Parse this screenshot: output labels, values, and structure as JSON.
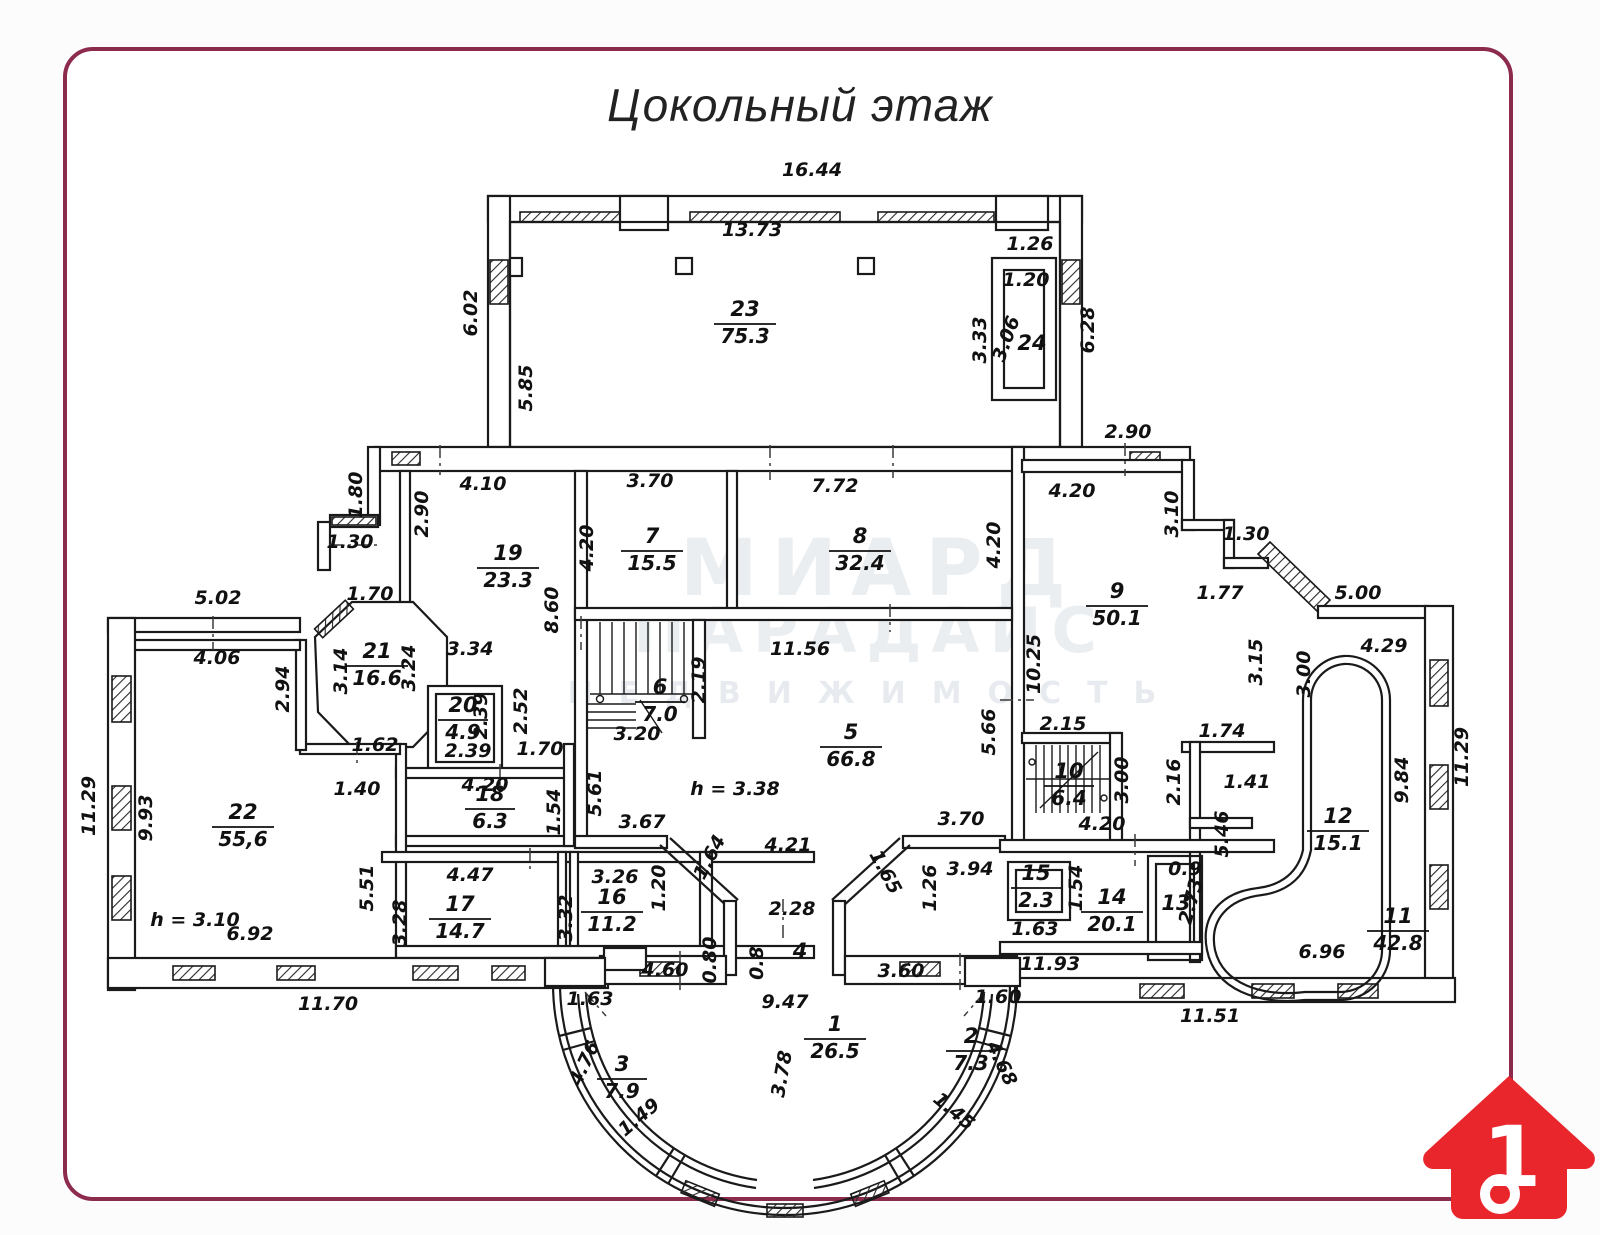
{
  "title": "Цокольный этаж",
  "watermark": {
    "line1": "МИАРД",
    "line2": "ПАРАДАИС",
    "line3": "НЕДВИЖИМОСТЬ"
  },
  "logo": {
    "number": "1",
    "house_color": "#e8262c"
  },
  "colors": {
    "border": "#8d2b4f",
    "lines": "#1a1a1a",
    "paper": "#ffffff"
  },
  "plan": {
    "rooms": [
      {
        "n": "23",
        "a": "75.3",
        "x": 745,
        "y": 316
      },
      {
        "n": "24",
        "a": null,
        "x": 1032,
        "y": 350
      },
      {
        "n": "19",
        "a": "23.3",
        "x": 508,
        "y": 560
      },
      {
        "n": "7",
        "a": "15.5",
        "x": 652,
        "y": 543
      },
      {
        "n": "8",
        "a": "32.4",
        "x": 860,
        "y": 543
      },
      {
        "n": "9",
        "a": "50.1",
        "x": 1117,
        "y": 598
      },
      {
        "n": "21",
        "a": "16.6",
        "x": 377,
        "y": 658
      },
      {
        "n": "20",
        "a": "4.9",
        "x": 463,
        "y": 712
      },
      {
        "n": "6",
        "a": "7.0",
        "x": 660,
        "y": 694
      },
      {
        "n": "5",
        "a": "66.8",
        "x": 851,
        "y": 739
      },
      {
        "n": "18",
        "a": "6.3",
        "x": 490,
        "y": 801
      },
      {
        "n": "22",
        "a": "55,6",
        "x": 243,
        "y": 819
      },
      {
        "n": "17",
        "a": "14.7",
        "x": 460,
        "y": 911
      },
      {
        "n": "16",
        "a": "11.2",
        "x": 612,
        "y": 904
      },
      {
        "n": "10",
        "a": "6.4",
        "x": 1069,
        "y": 778
      },
      {
        "n": "15",
        "a": "2.3",
        "x": 1036,
        "y": 880
      },
      {
        "n": "14",
        "a": "20.1",
        "x": 1112,
        "y": 904
      },
      {
        "n": "13",
        "a": null,
        "x": 1176,
        "y": 910
      },
      {
        "n": "12",
        "a": "15.1",
        "x": 1338,
        "y": 823
      },
      {
        "n": "11",
        "a": "42.8",
        "x": 1398,
        "y": 923
      },
      {
        "n": "4",
        "a": null,
        "x": 800,
        "y": 958
      },
      {
        "n": "1",
        "a": "26.5",
        "x": 835,
        "y": 1031
      },
      {
        "n": "2",
        "a": "7.3",
        "x": 971,
        "y": 1043
      },
      {
        "n": "3",
        "a": "7.9",
        "x": 622,
        "y": 1071
      }
    ],
    "dims": [
      {
        "t": "16.44",
        "x": 812,
        "y": 176
      },
      {
        "t": "13.73",
        "x": 752,
        "y": 236
      },
      {
        "t": "6.02",
        "x": 477,
        "y": 313,
        "r": -90
      },
      {
        "t": "5.85",
        "x": 532,
        "y": 388,
        "r": -90
      },
      {
        "t": "1.26",
        "x": 1030,
        "y": 250
      },
      {
        "t": "1.20",
        "x": 1026,
        "y": 286
      },
      {
        "t": "3.33",
        "x": 986,
        "y": 340,
        "r": -90
      },
      {
        "t": "3.06",
        "x": 1012,
        "y": 341,
        "r": -70
      },
      {
        "t": "6.28",
        "x": 1094,
        "y": 330,
        "r": -90
      },
      {
        "t": "2.90",
        "x": 1128,
        "y": 438
      },
      {
        "t": "1.80",
        "x": 362,
        "y": 495,
        "r": -90
      },
      {
        "t": "2.90",
        "x": 428,
        "y": 514,
        "r": -90
      },
      {
        "t": "4.10",
        "x": 483,
        "y": 490
      },
      {
        "t": "1.30",
        "x": 350,
        "y": 548
      },
      {
        "t": "5.02",
        "x": 218,
        "y": 604
      },
      {
        "t": "1.70",
        "x": 370,
        "y": 600
      },
      {
        "t": "4.06",
        "x": 217,
        "y": 664
      },
      {
        "t": "2.94",
        "x": 289,
        "y": 689,
        "r": -90
      },
      {
        "t": "3.14",
        "x": 347,
        "y": 671,
        "r": -90
      },
      {
        "t": "3.24",
        "x": 415,
        "y": 668,
        "r": -90
      },
      {
        "t": "1.62",
        "x": 375,
        "y": 751
      },
      {
        "t": "3.34",
        "x": 470,
        "y": 655
      },
      {
        "t": "8.60",
        "x": 558,
        "y": 610,
        "r": -90
      },
      {
        "t": "4.20",
        "x": 593,
        "y": 548,
        "r": -90
      },
      {
        "t": "3.70",
        "x": 650,
        "y": 487
      },
      {
        "t": "7.72",
        "x": 835,
        "y": 492
      },
      {
        "t": "4.20",
        "x": 1000,
        "y": 545,
        "r": -90
      },
      {
        "t": "2.39",
        "x": 487,
        "y": 716,
        "r": -90
      },
      {
        "t": "2.52",
        "x": 527,
        "y": 711,
        "r": -90
      },
      {
        "t": "2.39",
        "x": 468,
        "y": 757
      },
      {
        "t": "1.70",
        "x": 540,
        "y": 755
      },
      {
        "t": "1.40",
        "x": 357,
        "y": 795
      },
      {
        "t": "4.20",
        "x": 485,
        "y": 791
      },
      {
        "t": "1.54",
        "x": 560,
        "y": 812,
        "r": -90
      },
      {
        "t": "5.61",
        "x": 601,
        "y": 793,
        "r": -90
      },
      {
        "t": "3.67",
        "x": 642,
        "y": 828
      },
      {
        "t": "11.56",
        "x": 800,
        "y": 655
      },
      {
        "t": "2.19",
        "x": 705,
        "y": 680,
        "r": -90
      },
      {
        "t": "3.20",
        "x": 637,
        "y": 740
      },
      {
        "t": "h = 3.38",
        "x": 735,
        "y": 795
      },
      {
        "t": "5.66",
        "x": 995,
        "y": 732,
        "r": -90
      },
      {
        "t": "4.21",
        "x": 788,
        "y": 851
      },
      {
        "t": "1.64",
        "x": 715,
        "y": 860,
        "r": -62
      },
      {
        "t": "1.65",
        "x": 880,
        "y": 875,
        "r": 62
      },
      {
        "t": "3.70",
        "x": 961,
        "y": 825
      },
      {
        "t": "4.47",
        "x": 470,
        "y": 881
      },
      {
        "t": "3.28",
        "x": 406,
        "y": 923,
        "r": -90
      },
      {
        "t": "5.51",
        "x": 373,
        "y": 888,
        "r": -90
      },
      {
        "t": "3.32",
        "x": 572,
        "y": 918,
        "r": -90
      },
      {
        "t": "3.26",
        "x": 615,
        "y": 883
      },
      {
        "t": "1.20",
        "x": 665,
        "y": 888,
        "r": -90
      },
      {
        "t": "4.60",
        "x": 665,
        "y": 976
      },
      {
        "t": "2.28",
        "x": 792,
        "y": 915
      },
      {
        "t": "0.80",
        "x": 716,
        "y": 960,
        "r": -90
      },
      {
        "t": "0.8",
        "x": 763,
        "y": 963,
        "r": -90
      },
      {
        "t": "3.60",
        "x": 901,
        "y": 977
      },
      {
        "t": "9.47",
        "x": 785,
        "y": 1008
      },
      {
        "t": "1.63",
        "x": 590,
        "y": 1005
      },
      {
        "t": "1.60",
        "x": 998,
        "y": 1003
      },
      {
        "t": "3.78",
        "x": 788,
        "y": 1075,
        "r": -80
      },
      {
        "t": "4.76",
        "x": 590,
        "y": 1066,
        "r": -65
      },
      {
        "t": "1.49",
        "x": 643,
        "y": 1122,
        "r": -40
      },
      {
        "t": "4.68",
        "x": 996,
        "y": 1066,
        "r": 65
      },
      {
        "t": "1.45",
        "x": 950,
        "y": 1116,
        "r": 40
      },
      {
        "t": "11.70",
        "x": 328,
        "y": 1010
      },
      {
        "t": "11.51",
        "x": 1210,
        "y": 1022
      },
      {
        "t": "11.93",
        "x": 1050,
        "y": 970
      },
      {
        "t": "6.96",
        "x": 1322,
        "y": 958
      },
      {
        "t": "9.93",
        "x": 152,
        "y": 818,
        "r": -90
      },
      {
        "t": "11.29",
        "x": 95,
        "y": 806,
        "r": -90
      },
      {
        "t": "h = 3.10",
        "x": 195,
        "y": 926
      },
      {
        "t": "6.92",
        "x": 250,
        "y": 940
      },
      {
        "t": "4.20",
        "x": 1072,
        "y": 497
      },
      {
        "t": "10.25",
        "x": 1040,
        "y": 664,
        "r": -90
      },
      {
        "t": "3.10",
        "x": 1178,
        "y": 514,
        "r": -90
      },
      {
        "t": "1.30",
        "x": 1246,
        "y": 540
      },
      {
        "t": "1.77",
        "x": 1220,
        "y": 599
      },
      {
        "t": "3.15",
        "x": 1262,
        "y": 662,
        "r": -90
      },
      {
        "t": "3.00",
        "x": 1310,
        "y": 674,
        "r": -90
      },
      {
        "t": "5.00",
        "x": 1358,
        "y": 599
      },
      {
        "t": "4.29",
        "x": 1384,
        "y": 652
      },
      {
        "t": "2.15",
        "x": 1063,
        "y": 730
      },
      {
        "t": "1.74",
        "x": 1222,
        "y": 737
      },
      {
        "t": "3.00",
        "x": 1128,
        "y": 780,
        "r": -90
      },
      {
        "t": "2.16",
        "x": 1180,
        "y": 782,
        "r": -90
      },
      {
        "t": "4.20",
        "x": 1102,
        "y": 830
      },
      {
        "t": "1.41",
        "x": 1247,
        "y": 788
      },
      {
        "t": "5.46",
        "x": 1228,
        "y": 834,
        "r": -90
      },
      {
        "t": "9.84",
        "x": 1408,
        "y": 780,
        "r": -90
      },
      {
        "t": "11.29",
        "x": 1468,
        "y": 757,
        "r": -90
      },
      {
        "t": "3.94",
        "x": 970,
        "y": 875
      },
      {
        "t": "1.26",
        "x": 936,
        "y": 888,
        "r": -90
      },
      {
        "t": "1.63",
        "x": 1035,
        "y": 935
      },
      {
        "t": "1.54",
        "x": 1082,
        "y": 888,
        "r": -90
      },
      {
        "t": "0.9",
        "x": 1185,
        "y": 875
      },
      {
        "t": "2.73",
        "x": 1197,
        "y": 903,
        "r": -75
      }
    ]
  }
}
